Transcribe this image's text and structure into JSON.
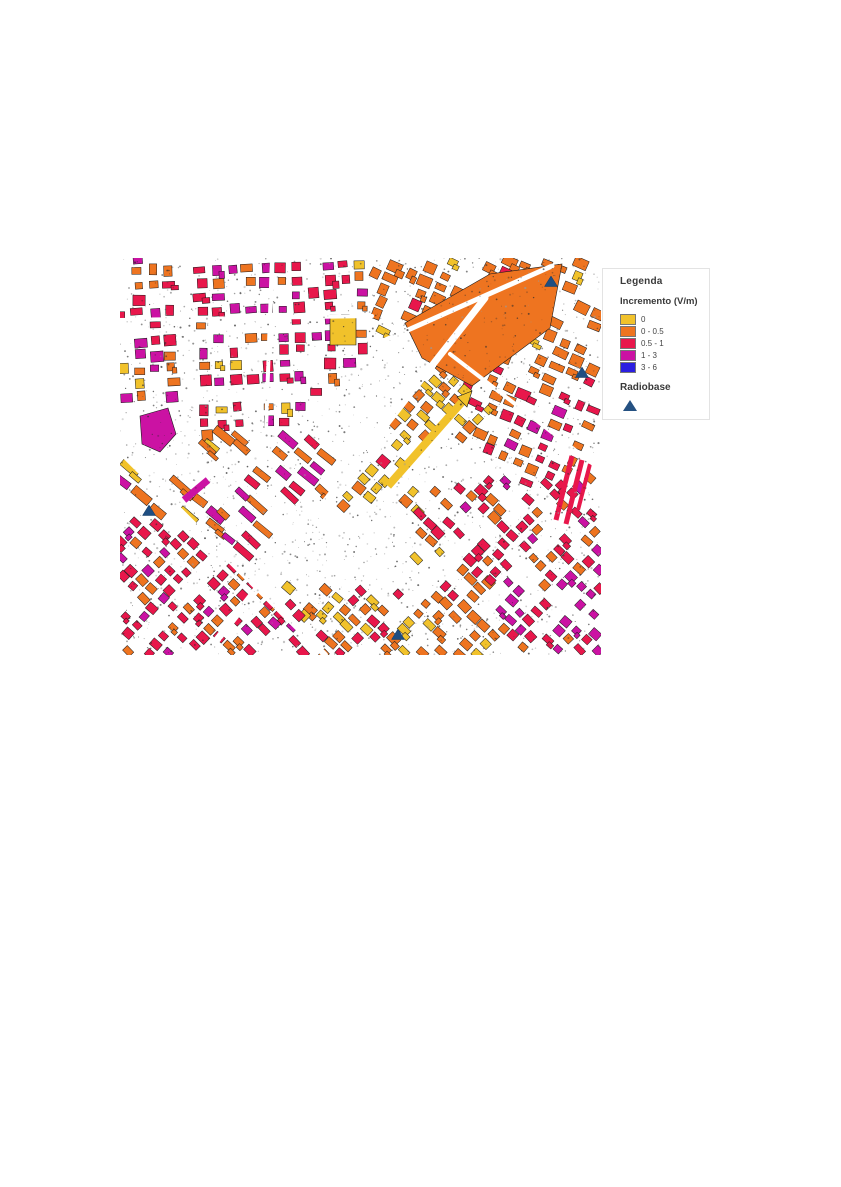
{
  "page": {
    "background": "#ffffff"
  },
  "legend": {
    "title": "Legenda",
    "subtitle": "Incremento (V/m)",
    "items": [
      {
        "label": "0",
        "color": "#F1C22B"
      },
      {
        "label": "0 - 0.5",
        "color": "#EE7420"
      },
      {
        "label": "0.5 - 1",
        "color": "#E8174B"
      },
      {
        "label": "1 - 3",
        "color": "#CB12A3"
      },
      {
        "label": "3 - 6",
        "color": "#2B1FE0"
      }
    ],
    "marker_section": {
      "label": "Radiobase",
      "symbol": "triangle",
      "color": "#255182"
    }
  },
  "map": {
    "position": {
      "left": 120,
      "top": 258,
      "width": 481,
      "height": 397
    },
    "seed": 13,
    "palette": {
      "yellow": "#F1C22B",
      "orange": "#EE7420",
      "red": "#E8174B",
      "magenta": "#CB12A3",
      "markerBlue": "#1F4E82",
      "outline": "#1a1a1a"
    },
    "radiobase_markers": [
      [
        431,
        24
      ],
      [
        462,
        115
      ],
      [
        29,
        253
      ],
      [
        278,
        377
      ]
    ],
    "zones": [
      {
        "name": "top-left-grid",
        "poly": [
          [
            0,
            0
          ],
          [
            252,
            0
          ],
          [
            252,
            88
          ],
          [
            160,
            168
          ],
          [
            88,
            178
          ],
          [
            0,
            178
          ]
        ],
        "angle": -2,
        "su": 16,
        "sv": 14,
        "bw": [
          7,
          13
        ],
        "bh": [
          6,
          11
        ],
        "density": 0.85,
        "gaps": [
          4,
          5
        ],
        "colors": [
          [
            "red",
            0.48
          ],
          [
            "orange",
            0.27
          ],
          [
            "magenta",
            0.19
          ],
          [
            "yellow",
            0.06
          ]
        ],
        "clusters": [
          {
            "rect": [
              92,
              4,
              58,
              56
            ],
            "color": "magenta",
            "p": 0.5
          },
          {
            "rect": [
              185,
              48,
              55,
              52
            ],
            "color": "yellow",
            "p": 0.3
          }
        ]
      },
      {
        "name": "top-right-orange",
        "poly": [
          [
            252,
            0
          ],
          [
            481,
            0
          ],
          [
            481,
            118
          ],
          [
            392,
            142
          ],
          [
            330,
            96
          ],
          [
            252,
            86
          ]
        ],
        "angle": 24,
        "su": 17,
        "sv": 13,
        "bw": [
          8,
          15
        ],
        "bh": [
          6,
          11
        ],
        "density": 0.8,
        "gaps": [
          4,
          5
        ],
        "colors": [
          [
            "orange",
            0.88
          ],
          [
            "red",
            0.06
          ],
          [
            "yellow",
            0.04
          ],
          [
            "magenta",
            0.02
          ]
        ]
      },
      {
        "name": "right-mid",
        "poly": [
          [
            330,
            96
          ],
          [
            392,
            142
          ],
          [
            481,
            118
          ],
          [
            481,
            200
          ],
          [
            412,
            232
          ],
          [
            340,
            180
          ]
        ],
        "angle": 24,
        "su": 16,
        "sv": 13,
        "bw": [
          7,
          13
        ],
        "bh": [
          6,
          10
        ],
        "density": 0.8,
        "gaps": [
          4,
          5
        ],
        "colors": [
          [
            "orange",
            0.52
          ],
          [
            "red",
            0.34
          ],
          [
            "magenta",
            0.14
          ]
        ]
      },
      {
        "name": "center-yellow-band",
        "poly": [
          [
            148,
            332
          ],
          [
            250,
            198
          ],
          [
            320,
            98
          ],
          [
            390,
            144
          ],
          [
            300,
            252
          ],
          [
            208,
            362
          ],
          [
            150,
            362
          ]
        ],
        "angle": 42,
        "su": 15,
        "sv": 12,
        "bw": [
          7,
          12
        ],
        "bh": [
          6,
          10
        ],
        "density": 0.85,
        "gaps": [
          4,
          4
        ],
        "colors": [
          [
            "yellow",
            0.7
          ],
          [
            "orange",
            0.27
          ],
          [
            "red",
            0.03
          ]
        ]
      },
      {
        "name": "mid-left-sparse",
        "poly": [
          [
            0,
            178
          ],
          [
            88,
            178
          ],
          [
            160,
            168
          ],
          [
            150,
            252
          ],
          [
            60,
            268
          ],
          [
            0,
            252
          ]
        ],
        "angle": 40,
        "su": 24,
        "sv": 17,
        "bw": [
          14,
          24
        ],
        "bh": [
          6,
          9
        ],
        "density": 0.55,
        "gaps": [
          5,
          6
        ],
        "colors": [
          [
            "orange",
            0.45
          ],
          [
            "magenta",
            0.28
          ],
          [
            "yellow",
            0.15
          ],
          [
            "red",
            0.12
          ]
        ]
      },
      {
        "name": "center-left-elongated",
        "poly": [
          [
            88,
            178
          ],
          [
            160,
            168
          ],
          [
            252,
            196
          ],
          [
            148,
            332
          ],
          [
            60,
            268
          ]
        ],
        "angle": 41,
        "su": 19,
        "sv": 14,
        "bw": [
          12,
          22
        ],
        "bh": [
          5,
          8
        ],
        "density": 0.6,
        "gaps": [
          4,
          5
        ],
        "colors": [
          [
            "magenta",
            0.38
          ],
          [
            "red",
            0.34
          ],
          [
            "orange",
            0.28
          ]
        ]
      },
      {
        "name": "bottom-left-dense",
        "poly": [
          [
            0,
            252
          ],
          [
            60,
            268
          ],
          [
            148,
            332
          ],
          [
            208,
            362
          ],
          [
            196,
            397
          ],
          [
            0,
            397
          ]
        ],
        "angle": 44,
        "su": 14,
        "sv": 12,
        "bw": [
          7,
          11
        ],
        "bh": [
          6,
          9
        ],
        "density": 0.9,
        "gaps": [
          4,
          5
        ],
        "colors": [
          [
            "red",
            0.58
          ],
          [
            "orange",
            0.24
          ],
          [
            "magenta",
            0.18
          ]
        ]
      },
      {
        "name": "bottom-center",
        "poly": [
          [
            196,
            397
          ],
          [
            208,
            362
          ],
          [
            300,
            252
          ],
          [
            360,
            300
          ],
          [
            396,
            397
          ]
        ],
        "angle": 44,
        "su": 14,
        "sv": 12,
        "bw": [
          7,
          12
        ],
        "bh": [
          6,
          9
        ],
        "density": 0.88,
        "gaps": [
          4,
          5
        ],
        "colors": [
          [
            "orange",
            0.55
          ],
          [
            "yellow",
            0.22
          ],
          [
            "red",
            0.23
          ]
        ]
      },
      {
        "name": "right-red",
        "poly": [
          [
            300,
            252
          ],
          [
            340,
            180
          ],
          [
            412,
            232
          ],
          [
            481,
            200
          ],
          [
            481,
            268
          ],
          [
            430,
            320
          ],
          [
            360,
            300
          ]
        ],
        "angle": 44,
        "su": 14,
        "sv": 12,
        "bw": [
          7,
          11
        ],
        "bh": [
          6,
          9
        ],
        "density": 0.88,
        "gaps": [
          4,
          5
        ],
        "colors": [
          [
            "red",
            0.62
          ],
          [
            "orange",
            0.2
          ],
          [
            "magenta",
            0.18
          ]
        ]
      },
      {
        "name": "bottom-right-magenta",
        "poly": [
          [
            430,
            320
          ],
          [
            481,
            268
          ],
          [
            481,
            397
          ],
          [
            396,
            397
          ],
          [
            360,
            300
          ]
        ],
        "angle": 44,
        "su": 14,
        "sv": 12,
        "bw": [
          7,
          11
        ],
        "bh": [
          6,
          9
        ],
        "density": 0.86,
        "gaps": [
          4,
          5
        ],
        "colors": [
          [
            "magenta",
            0.55
          ],
          [
            "red",
            0.28
          ],
          [
            "orange",
            0.17
          ]
        ]
      }
    ],
    "exclusions": [
      [
        150,
        250,
        140,
        78
      ],
      [
        282,
        180,
        76,
        50
      ],
      [
        268,
        62,
        58,
        46
      ],
      [
        6,
        148,
        50,
        54
      ],
      [
        62,
        196,
        66,
        40
      ]
    ],
    "features": [
      {
        "type": "poly",
        "color": "orange",
        "points": [
          [
            285,
            65
          ],
          [
            370,
            16
          ],
          [
            442,
            6
          ],
          [
            430,
            70
          ],
          [
            352,
            128
          ],
          [
            302,
            100
          ]
        ]
      },
      {
        "type": "poly",
        "color": "magenta",
        "points": [
          [
            20,
            158
          ],
          [
            48,
            150
          ],
          [
            56,
            176
          ],
          [
            40,
            194
          ],
          [
            22,
            186
          ]
        ]
      },
      {
        "type": "line",
        "color": "magenta",
        "from": [
          64,
          242
        ],
        "to": [
          88,
          222
        ],
        "w": 7
      },
      {
        "type": "line",
        "color": "red",
        "from": [
          436,
          262
        ],
        "to": [
          452,
          198
        ],
        "w": 5
      },
      {
        "type": "line",
        "color": "red",
        "from": [
          446,
          266
        ],
        "to": [
          462,
          202
        ],
        "w": 5
      },
      {
        "type": "line",
        "color": "red",
        "from": [
          458,
          252
        ],
        "to": [
          470,
          206
        ],
        "w": 4
      },
      {
        "type": "poly",
        "color": "yellow",
        "points": [
          [
            210,
            57
          ],
          [
            236,
            57
          ],
          [
            236,
            87
          ],
          [
            210,
            87
          ]
        ]
      }
    ],
    "roads": [
      [
        85,
        397,
        365,
        40,
        7
      ],
      [
        0,
        193,
        205,
        397,
        6
      ],
      [
        0,
        62,
        252,
        58,
        4
      ],
      [
        252,
        88,
        432,
        8,
        5
      ],
      [
        330,
        96,
        481,
        212,
        4
      ],
      [
        152,
        0,
        146,
        172,
        4
      ]
    ],
    "post_road_features": [
      {
        "type": "line",
        "color": "yellow",
        "from": [
          268,
          228
        ],
        "to": [
          342,
          144
        ],
        "w": 8
      },
      {
        "type": "poly",
        "color": "yellow",
        "points": [
          [
            347,
            149
          ],
          [
            337,
            139
          ],
          [
            352,
            133
          ]
        ]
      }
    ],
    "noise": {
      "dark_count": 1700,
      "light_count": 300
    }
  }
}
